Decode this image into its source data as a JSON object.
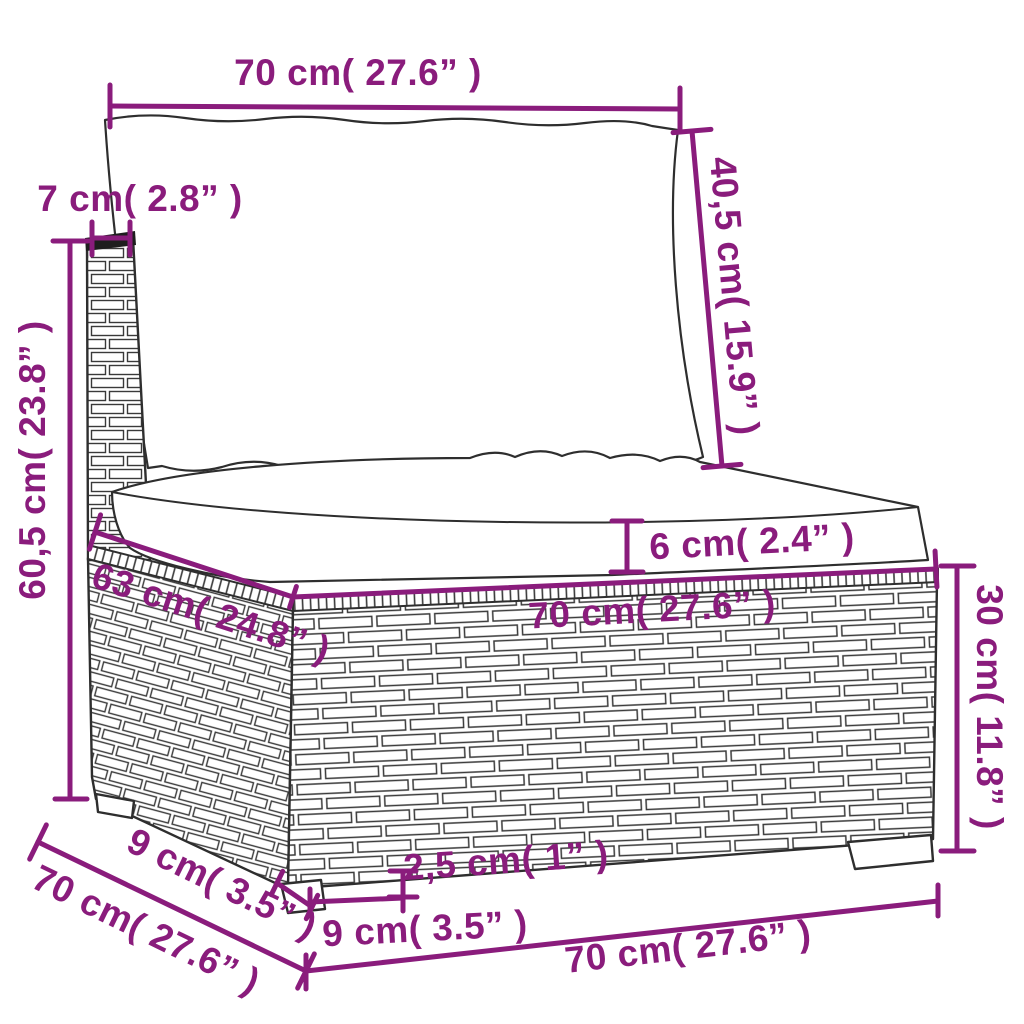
{
  "diagram": {
    "kind": "furniture-dimension-diagram",
    "subject": "rattan-garden-sofa-middle-section"
  },
  "colors": {
    "dimension_color": "#8a1c7c",
    "outline_color": "#2e2e2e",
    "cushion_fill": "#ffffff",
    "background": "#ffffff"
  },
  "dimensions": {
    "top_width": "70 cm( 27.6” )",
    "backrest_height": "40,5 cm( 15.9” )",
    "post_width": "7 cm( 2.8” )",
    "total_height": "60,5 cm( 23.8” )",
    "cushion_thickness": "6 cm( 2.4” )",
    "seat_depth": "63 cm( 24.8” )",
    "seat_width": "70 cm( 27.6” )",
    "base_height": "30 cm( 11.8” )",
    "side_depth": "70 cm( 27.6” )",
    "leg_depth": "9 cm( 3.5” )",
    "leg_height": "2,5 cm( 1” )",
    "leg_width": "9 cm( 3.5” )",
    "base_width": "70 cm( 27.6” )"
  }
}
